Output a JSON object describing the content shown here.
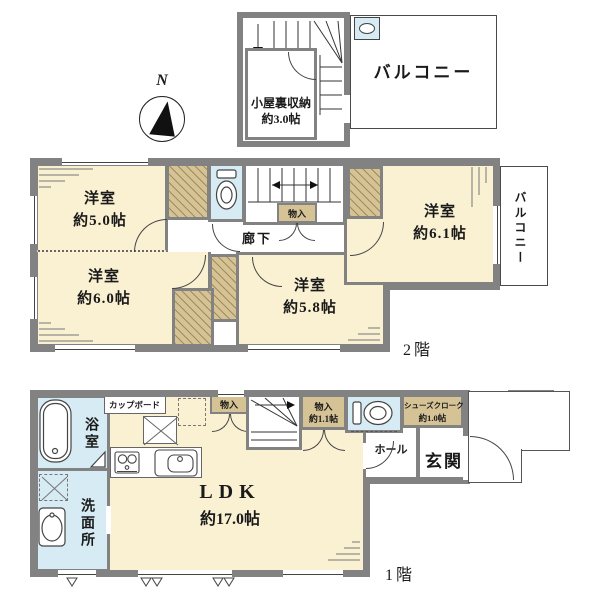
{
  "colors": {
    "room_cream": "#faf1d3",
    "closet_tan": "#d5c295",
    "wet_blue": "#d6ebf4",
    "wall_gray": "#828282",
    "line_dark": "#444444"
  },
  "compass": {
    "north_label": "N"
  },
  "attic": {
    "storage_name": "小屋裏収納",
    "storage_size": "約3.0帖",
    "balcony_label": "バルコニー"
  },
  "floor2": {
    "floor_label": "2階",
    "bedroom_nw": {
      "name": "洋室",
      "size": "約5.0帖"
    },
    "bedroom_sw": {
      "name": "洋室",
      "size": "約6.0帖"
    },
    "bedroom_s": {
      "name": "洋室",
      "size": "約5.8帖"
    },
    "bedroom_ne": {
      "name": "洋室",
      "size": "約6.1帖"
    },
    "corridor_label": "廊下",
    "storage_label": "物入",
    "balcony_label": "バルコニー"
  },
  "floor1": {
    "floor_label": "1階",
    "ldk": {
      "name": "LDK",
      "size": "約17.0帖"
    },
    "bath_label": "浴室",
    "washroom_label": "洗面所",
    "hall_label": "ホール",
    "entrance_label": "玄関",
    "cupboard_label": "カップボード",
    "storage_small_label": "物入",
    "storage": {
      "name": "物入",
      "size": "約1.1帖"
    },
    "shoes_closet": {
      "name": "シューズクローク",
      "size": "約1.0帖"
    }
  }
}
